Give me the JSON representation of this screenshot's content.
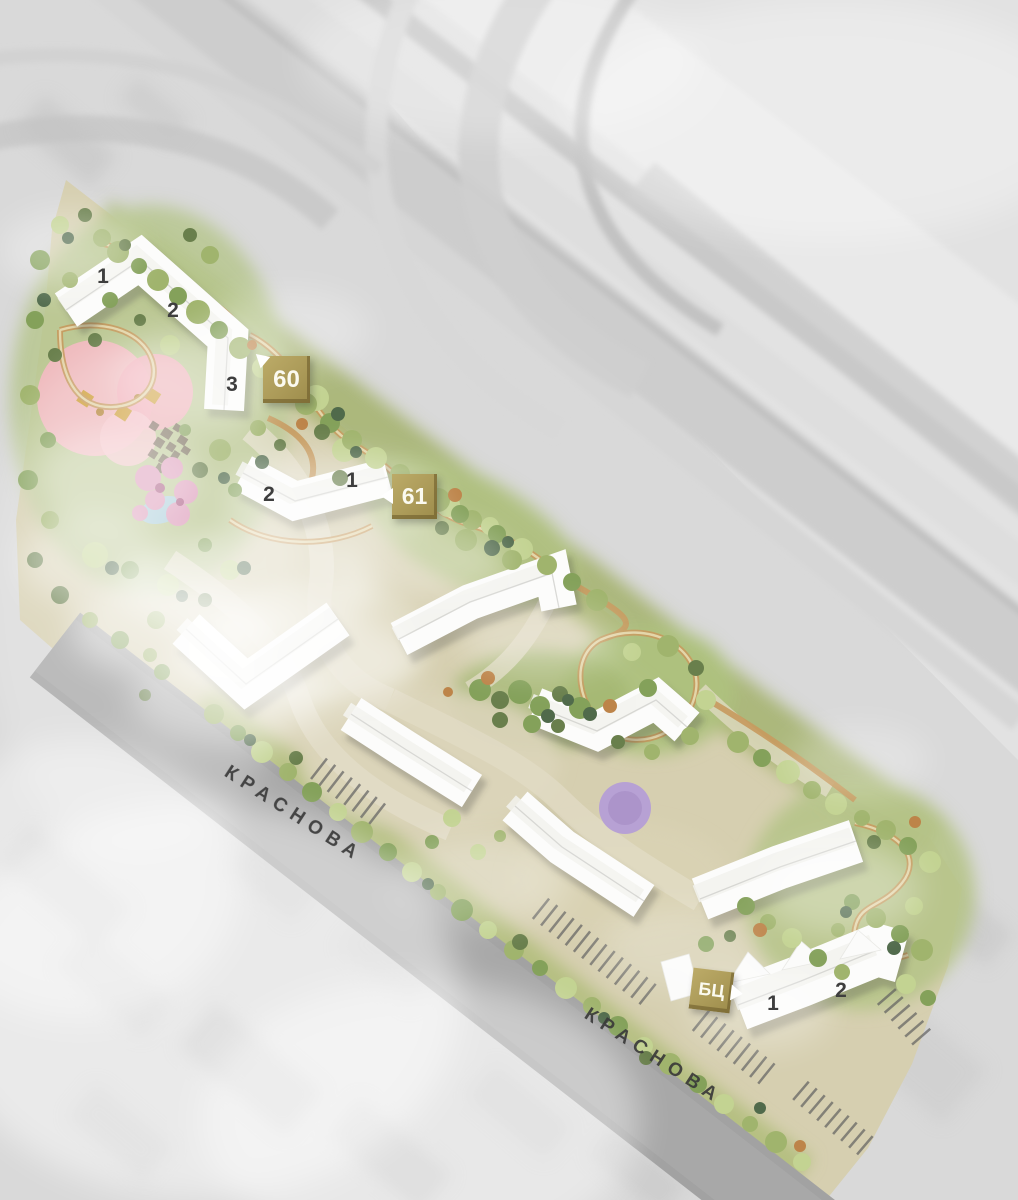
{
  "site_plan": {
    "title": "residential-complex-masterplan",
    "streets": [
      {
        "name": "КРАСНОВА"
      },
      {
        "name": "КРАСНОВА"
      }
    ],
    "badges": [
      {
        "id": "building-60",
        "label": "60"
      },
      {
        "id": "building-61",
        "label": "61"
      },
      {
        "id": "business-center",
        "label": "БЦ"
      }
    ],
    "building_sections": [
      {
        "building": "60",
        "section": "1"
      },
      {
        "building": "60",
        "section": "2"
      },
      {
        "building": "60",
        "section": "3"
      },
      {
        "building": "61",
        "section": "2"
      },
      {
        "building": "61",
        "section": "1"
      },
      {
        "building": "business-center-block",
        "section": "1"
      },
      {
        "building": "business-center-block",
        "section": "2"
      }
    ],
    "colors": {
      "badge_gold": "#ac9b59",
      "badge_text": "#fbfaf0",
      "street_label_text": "#3a3a3a",
      "road_gray": "#a2a2a2",
      "site_ground": "#d6cfb0",
      "greenery": "#a0b46d",
      "building_white": "#fcfcfb",
      "playground_pink": "#f3b9c0",
      "pond_blue": "#aacdd9",
      "purple_tree": "#b7a1d4",
      "autumn_tree": "#bd8449"
    }
  }
}
